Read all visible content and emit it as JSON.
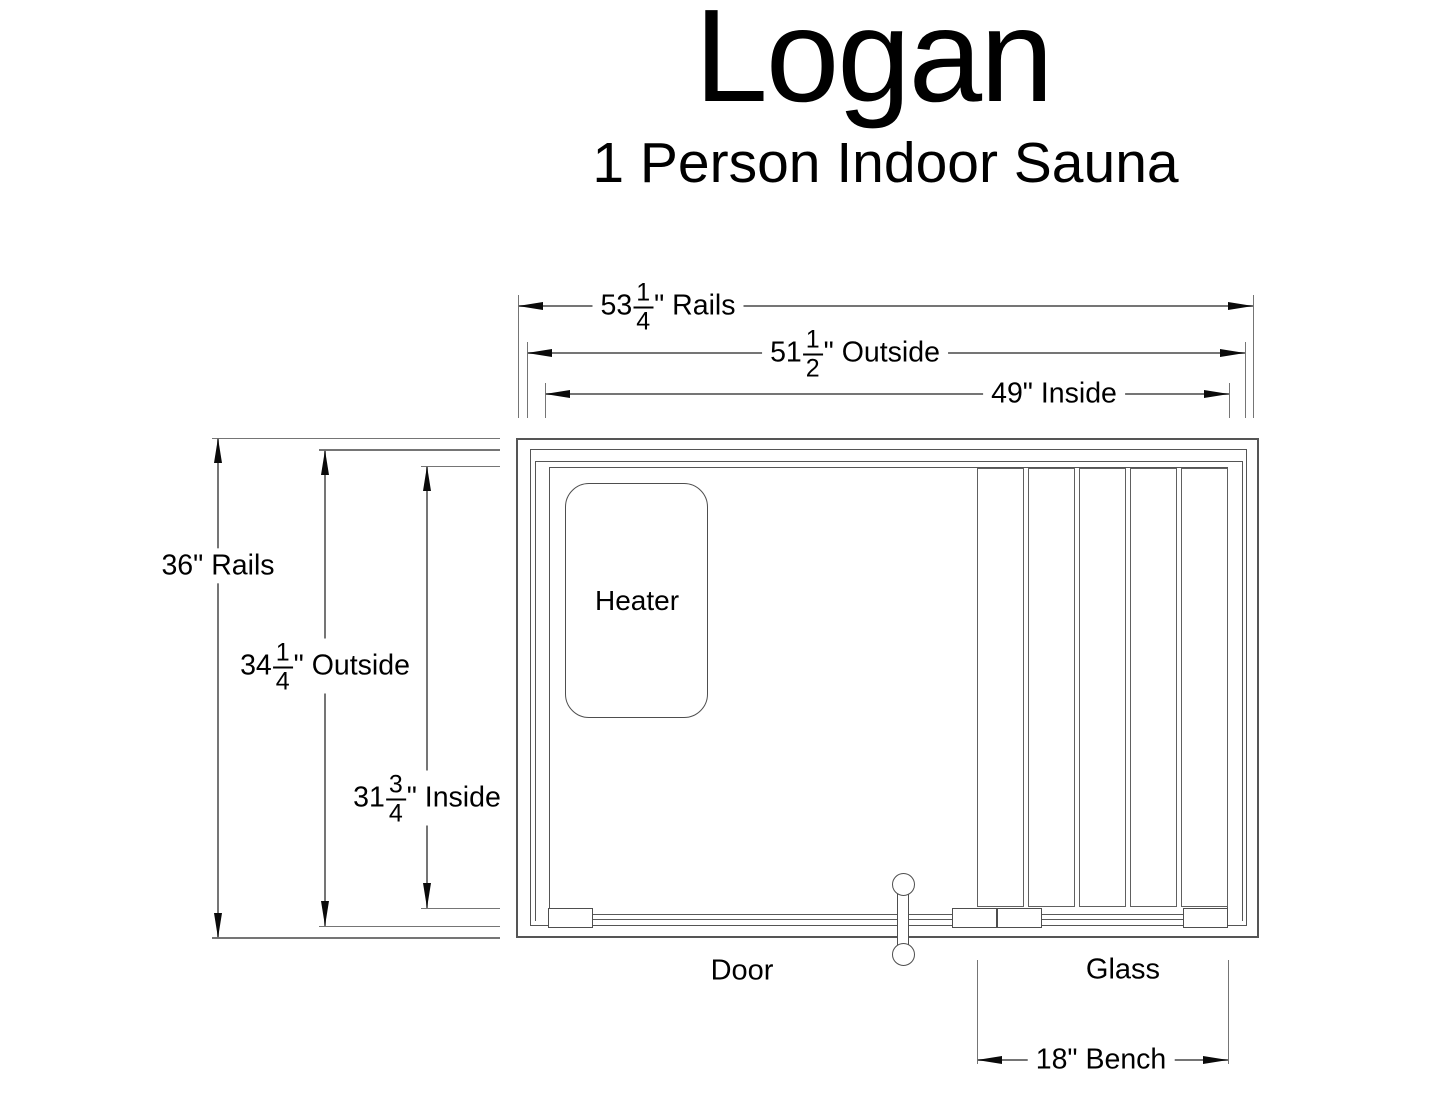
{
  "title": "Logan",
  "subtitle": "1 Person Indoor Sauna",
  "plan": {
    "heater_label": "Heater",
    "door_label": "Door",
    "glass_label": "Glass"
  },
  "dims": {
    "rails_w": {
      "whole": "53",
      "num": "1",
      "den": "4",
      "suffix": "\" Rails"
    },
    "outside_w": {
      "whole": "51",
      "num": "1",
      "den": "2",
      "suffix": "\" Outside"
    },
    "inside_w": {
      "whole": "49",
      "suffix": "\" Inside"
    },
    "bench_w": {
      "whole": "18",
      "suffix": "\" Bench"
    },
    "rails_h": {
      "whole": "36",
      "suffix": "\" Rails"
    },
    "outside_h": {
      "whole": "34",
      "num": "1",
      "den": "4",
      "suffix": "\" Outside"
    },
    "inside_h": {
      "whole": "31",
      "num": "3",
      "den": "4",
      "suffix": "\" Inside"
    }
  }
}
